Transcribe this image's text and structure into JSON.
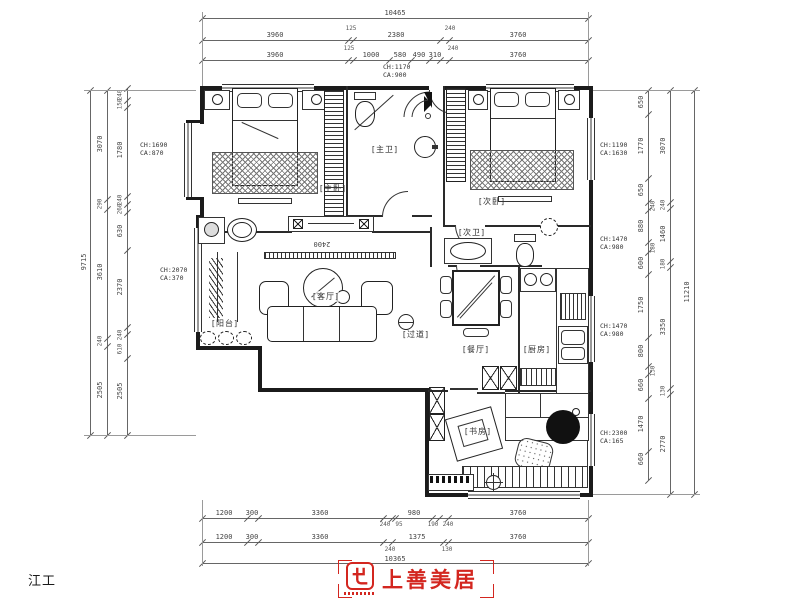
{
  "watermark": "江工",
  "dims": {
    "top": {
      "overall": "10465",
      "row2": [
        "3960",
        "125",
        "2380",
        "240",
        "3760"
      ],
      "row3": [
        "3960",
        "125",
        "1000",
        "580",
        "490",
        "310",
        "240",
        "3760"
      ]
    },
    "bottom": {
      "row1": [
        "1200",
        "300",
        "3360",
        "240",
        "95",
        "980",
        "190",
        "240",
        "3760"
      ],
      "row2": [
        "1200",
        "300",
        "3360",
        "240",
        "1375",
        "130",
        "3760"
      ],
      "overall": "10365"
    },
    "left": {
      "outer": "9715",
      "mid": [
        "3070",
        "290",
        "3610",
        "240",
        "2505"
      ],
      "inner": [
        "240",
        "150",
        "1780",
        "240",
        "260",
        "630",
        "2370",
        "240",
        "610",
        "2505"
      ]
    },
    "right": {
      "outer": "11210",
      "mid": [
        "3070",
        "240",
        "1460",
        "180",
        "3350",
        "130",
        "2770"
      ],
      "inner": [
        "650",
        "1770",
        "650",
        "240",
        "880",
        "180",
        "600",
        "1750",
        "800",
        "130",
        "660",
        "1470",
        "660"
      ]
    }
  },
  "notes": {
    "left_top": {
      "l1": "CH:1690",
      "l2": "CA:870"
    },
    "left_mid": {
      "l1": "CH:2070",
      "l2": "CA:370"
    },
    "top_center": {
      "l1": "CH:1170",
      "l2": "CA:900"
    },
    "right_top": {
      "l1": "CH:1190",
      "l2": "CA:1630"
    },
    "right_upper": {
      "l1": "CH:1470",
      "l2": "CA:980"
    },
    "right_mid": {
      "l1": "CH:1470",
      "l2": "CA:980"
    },
    "right_low": {
      "l1": "CH:2300",
      "l2": "CA:165"
    }
  },
  "rooms": {
    "master_bedroom": "[主卧]",
    "second_bedroom": "[次卧]",
    "master_bath": "[主卫]",
    "second_bath": "[次卫]",
    "living": "[客厅]",
    "dining": "[餐厅]",
    "kitchen": "[厨房]",
    "balcony": "[阳台]",
    "study": "[书房]",
    "hallway": "[过道]"
  },
  "annotations": {
    "tv_wall_width": "2400"
  },
  "logo": {
    "brand": "上善美居",
    "accent": "#d3261f"
  }
}
